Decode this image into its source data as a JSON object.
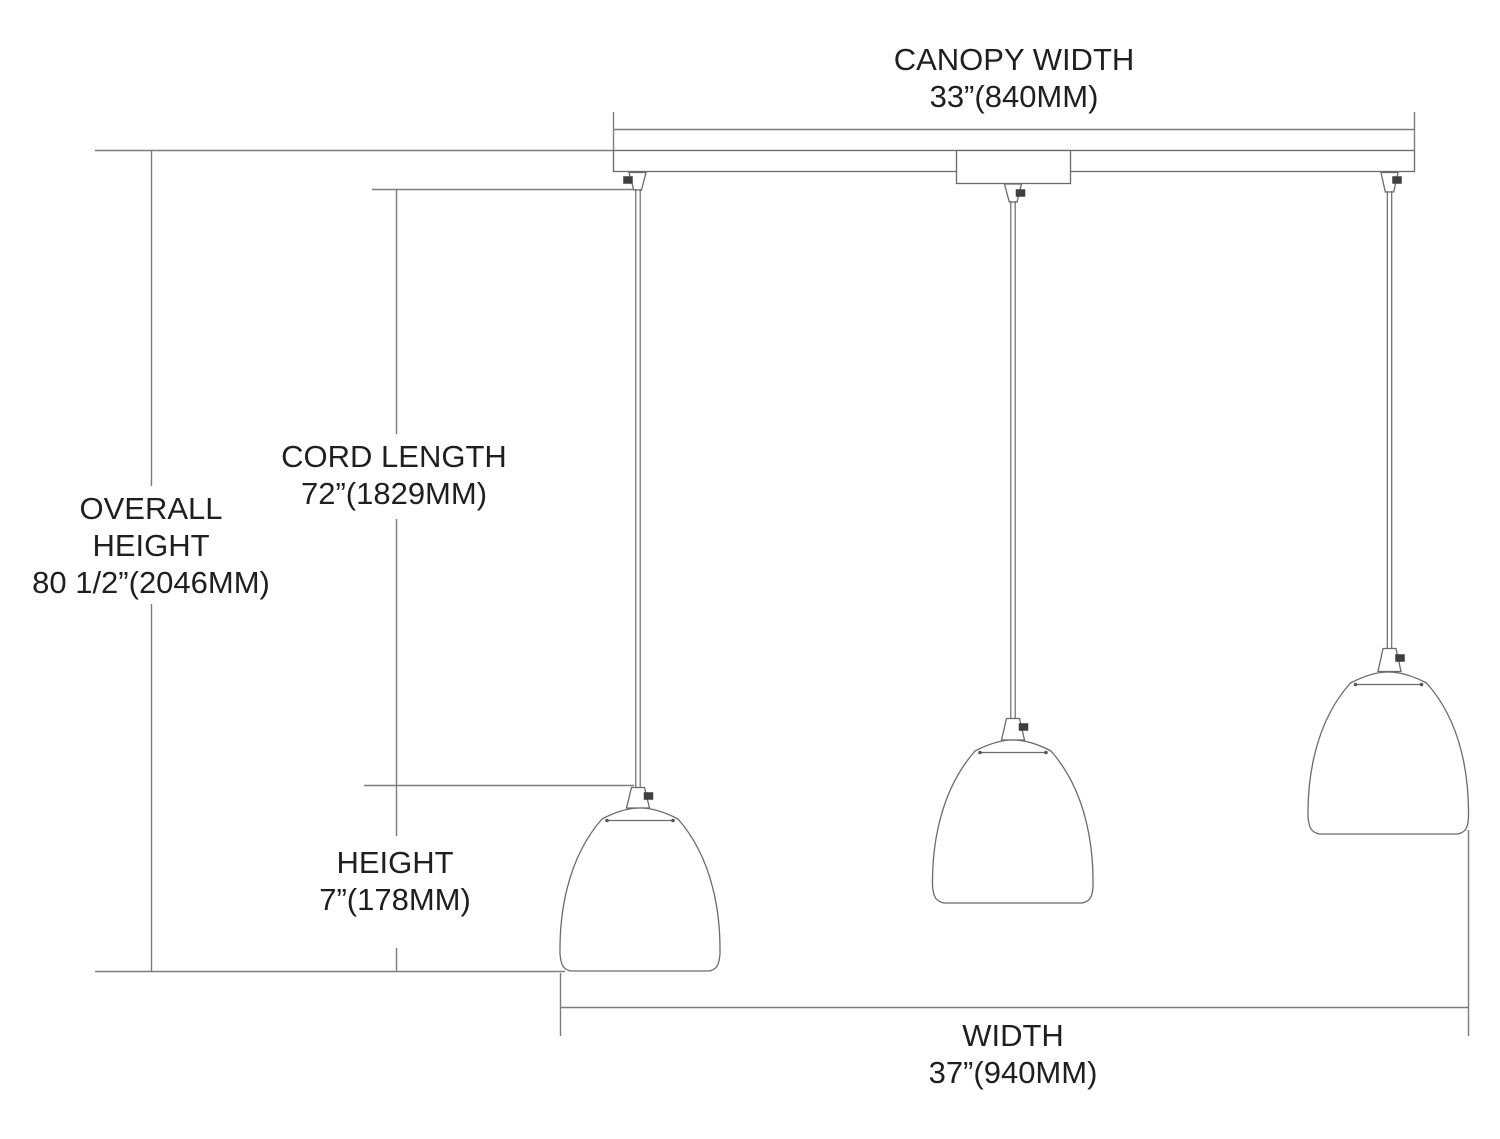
{
  "diagram": {
    "background_color": "#ffffff",
    "dimension_line_color": "#7d7d7d",
    "fixture_line_color": "#6a6a6a",
    "text_color": "#1f1f1f",
    "screw_color": "#3f3f3f",
    "dimensions": {
      "canopy_width": {
        "label": "CANOPY WIDTH",
        "value": "33”(840MM)"
      },
      "overall_height": {
        "label_line1": "OVERALL",
        "label_line2": "HEIGHT",
        "value": "80 1/2”(2046MM)"
      },
      "cord_length": {
        "label": "CORD LENGTH",
        "value": "72”(1829MM)"
      },
      "shade_height": {
        "label": "HEIGHT",
        "value": "7”(178MM)"
      },
      "fixture_width": {
        "label": "WIDTH",
        "value": "37”(940MM)"
      }
    }
  }
}
